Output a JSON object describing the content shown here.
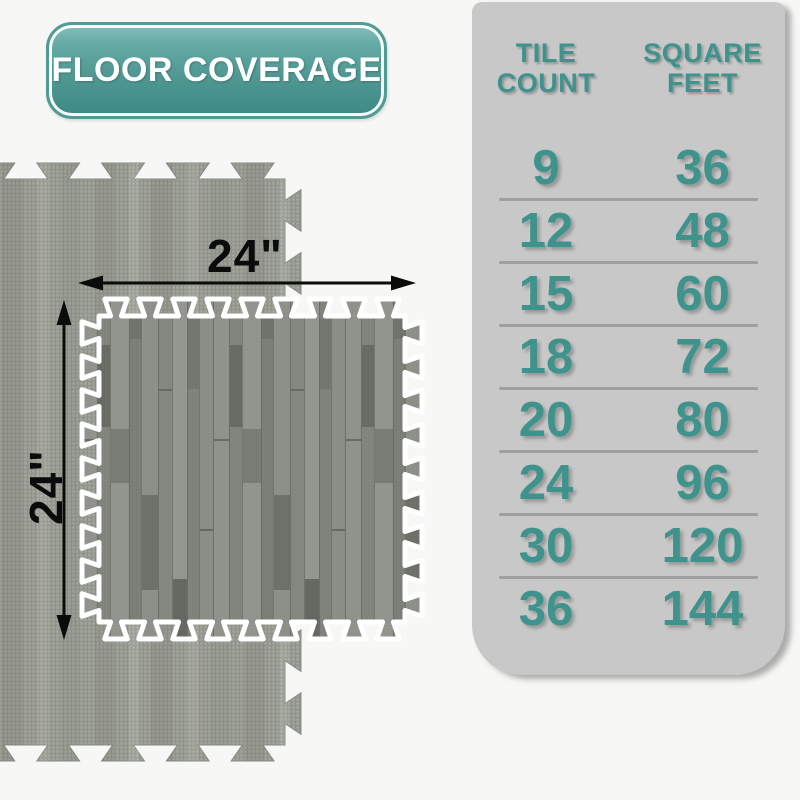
{
  "badge": {
    "label": "FLOOR COVERAGE"
  },
  "diagram": {
    "width_label": "24\"",
    "height_label": "24\"",
    "tile_size_inches": 24
  },
  "table": {
    "headers": [
      {
        "line1": "TILE",
        "line2": "COUNT"
      },
      {
        "line1": "SQUARE",
        "line2": "FEET"
      }
    ],
    "rows": [
      {
        "tiles": "9",
        "sqft": "36"
      },
      {
        "tiles": "12",
        "sqft": "48"
      },
      {
        "tiles": "15",
        "sqft": "60"
      },
      {
        "tiles": "18",
        "sqft": "72"
      },
      {
        "tiles": "20",
        "sqft": "80"
      },
      {
        "tiles": "24",
        "sqft": "96"
      },
      {
        "tiles": "30",
        "sqft": "120"
      },
      {
        "tiles": "36",
        "sqft": "144"
      }
    ]
  },
  "colors": {
    "teal_text": "#3E938D",
    "badge_teal": "#4F9792",
    "panel_gray": "#C8C8C8",
    "page_background": "#F7F7F6",
    "arrow_black": "#0B0B0B"
  }
}
